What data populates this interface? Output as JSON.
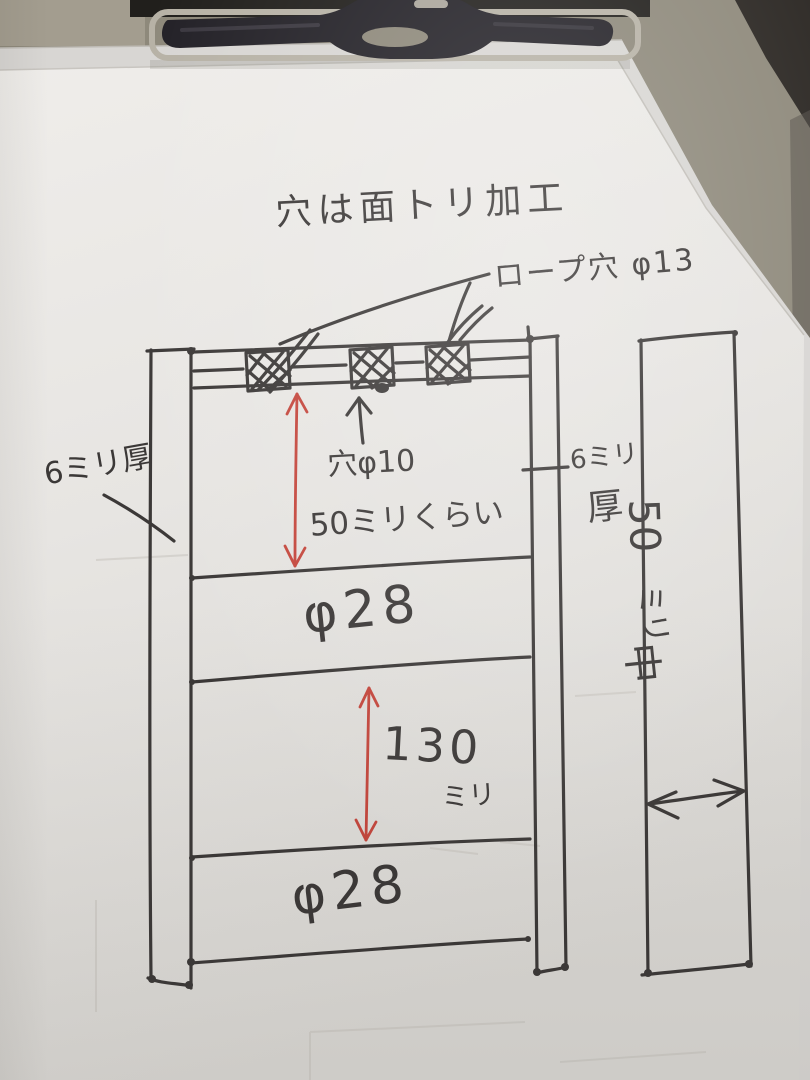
{
  "labels": {
    "title": "穴は面トリ加工",
    "rope_hole": "ロープ穴 φ13",
    "left_thickness": "6ミリ厚",
    "hole_dia": "穴φ10",
    "hole_pitch": "50ミリくらい",
    "right_thickness_top": "6ミリ",
    "right_thickness_bottom": "厚",
    "middle_rail_dia": "φ28",
    "gap_value": "130",
    "gap_unit": "ミリ",
    "bottom_rail_dia": "φ28",
    "bar_width_value": "50",
    "bar_width_unit": "ミリ",
    "bar_width_kanji": "中"
  },
  "colors": {
    "ink": "#3b3837",
    "red_ink": "#c4463c",
    "paper": "#e9e7e4",
    "under_sheet": "#d8d6d3",
    "clipboard": "#8e897b",
    "dark_background": "#27241f",
    "clip_black": "#232127",
    "clip_metal": "#b7b2a6"
  }
}
